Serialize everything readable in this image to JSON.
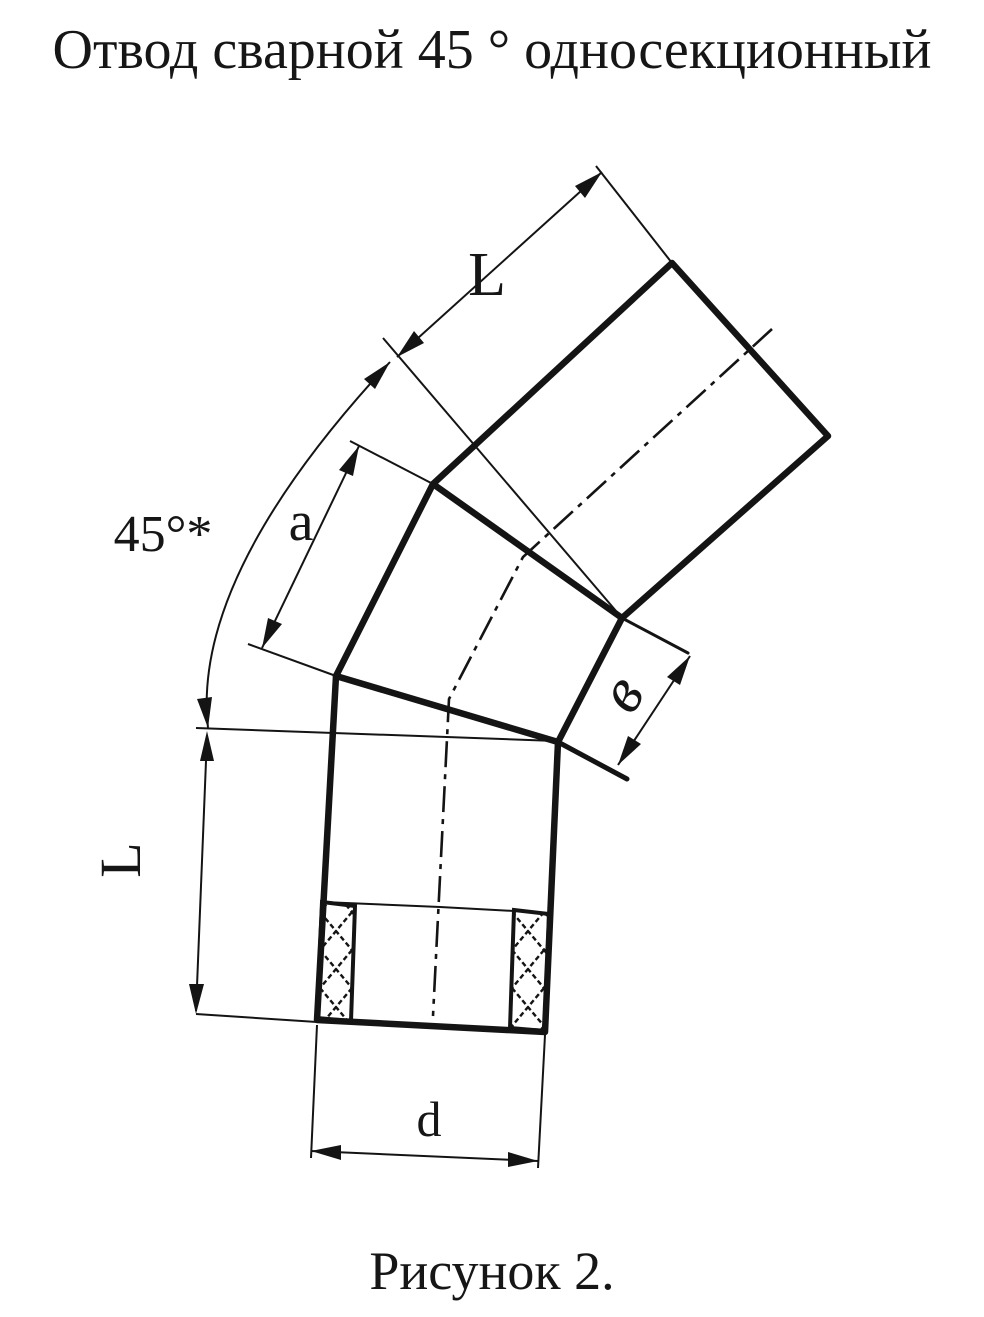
{
  "title": "Отвод сварной 45 ° односекционный",
  "caption": "Рисунок 2.",
  "labels": {
    "top_length": "L",
    "left_length": "L",
    "angle": "45°*",
    "section_width": "a",
    "seam_offset": "в",
    "diameter": "d"
  },
  "drawing_type": "welded 45-degree single-section pipe elbow, orthographic view with dimensions",
  "colors": {
    "ink": "#141414",
    "paper": "#ffffff"
  }
}
